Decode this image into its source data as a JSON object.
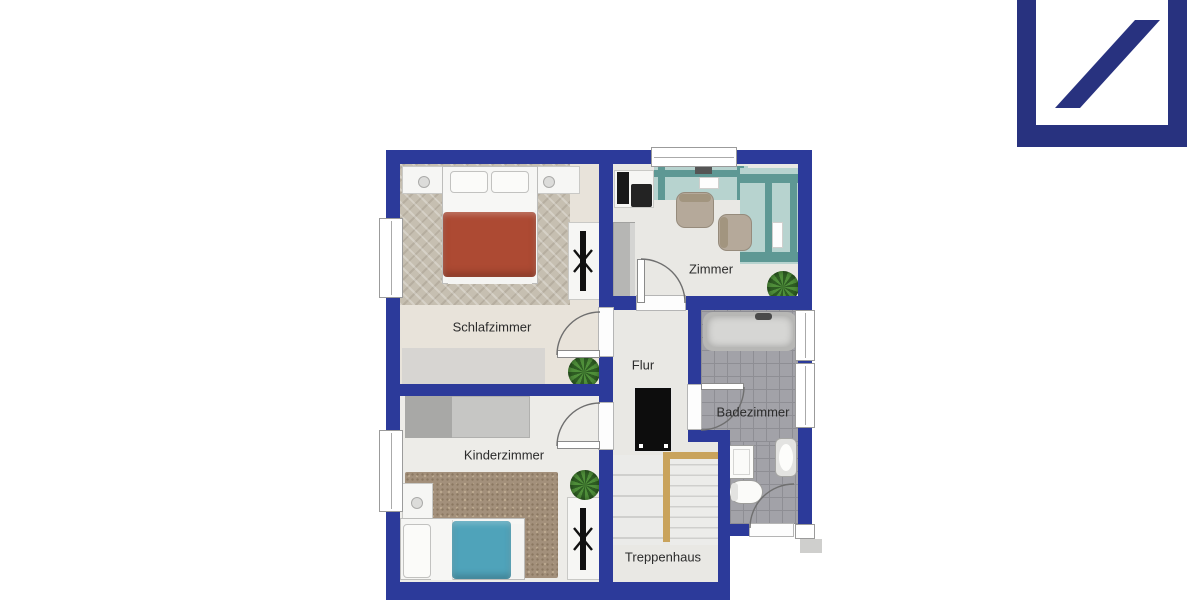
{
  "logo": {
    "name": "Deutsche Bank logo",
    "color": "#28327f"
  },
  "floorplan": {
    "rooms": [
      {
        "id": "schlafzimmer",
        "label": "Schlafzimmer"
      },
      {
        "id": "zimmer",
        "label": "Zimmer"
      },
      {
        "id": "flur",
        "label": "Flur"
      },
      {
        "id": "badezimmer",
        "label": "Badezimmer"
      },
      {
        "id": "kinderzimmer",
        "label": "Kinderzimmer"
      },
      {
        "id": "treppenhaus",
        "label": "Treppenhaus"
      }
    ],
    "colors": {
      "wall": "#2c3a9a",
      "logo": "#28327f",
      "bed_duvet_red": "#ad4a33",
      "kids_duvet_teal": "#4fa3ba",
      "desk_teal": "#b7d3cf",
      "desk_teal_frame": "#5e9894",
      "stair_rail_wood": "#c9a35c",
      "plant_green": "#3f7d2f",
      "bath_tile": "#a2a2a8"
    }
  }
}
